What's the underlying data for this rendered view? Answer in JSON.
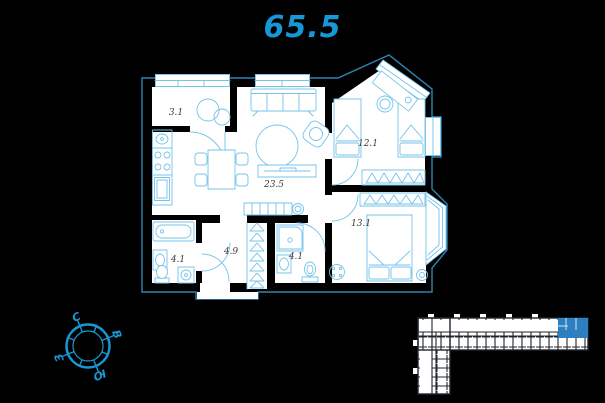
{
  "title": {
    "value": "65.5",
    "color": "#1798d6"
  },
  "plan": {
    "rooms": [
      {
        "area": "3.1"
      },
      {
        "area": "23.5"
      },
      {
        "area": "12.1"
      },
      {
        "area": "13.1"
      },
      {
        "area": "4.1"
      },
      {
        "area": "4.9"
      },
      {
        "area": "4.1"
      }
    ],
    "colors": {
      "floor": "#ffffff",
      "walls": "#000000",
      "furniture": "#74c3ea",
      "outline": "#2f84b5",
      "label": "#3a3a3a"
    }
  },
  "compass": {
    "north": "С",
    "east": "В",
    "south": "Ю",
    "west": "З",
    "color": "#1798d6"
  },
  "minimap": {
    "fill": "#ffffff",
    "lines": "#20262e",
    "highlight": "#2d7fc2"
  }
}
